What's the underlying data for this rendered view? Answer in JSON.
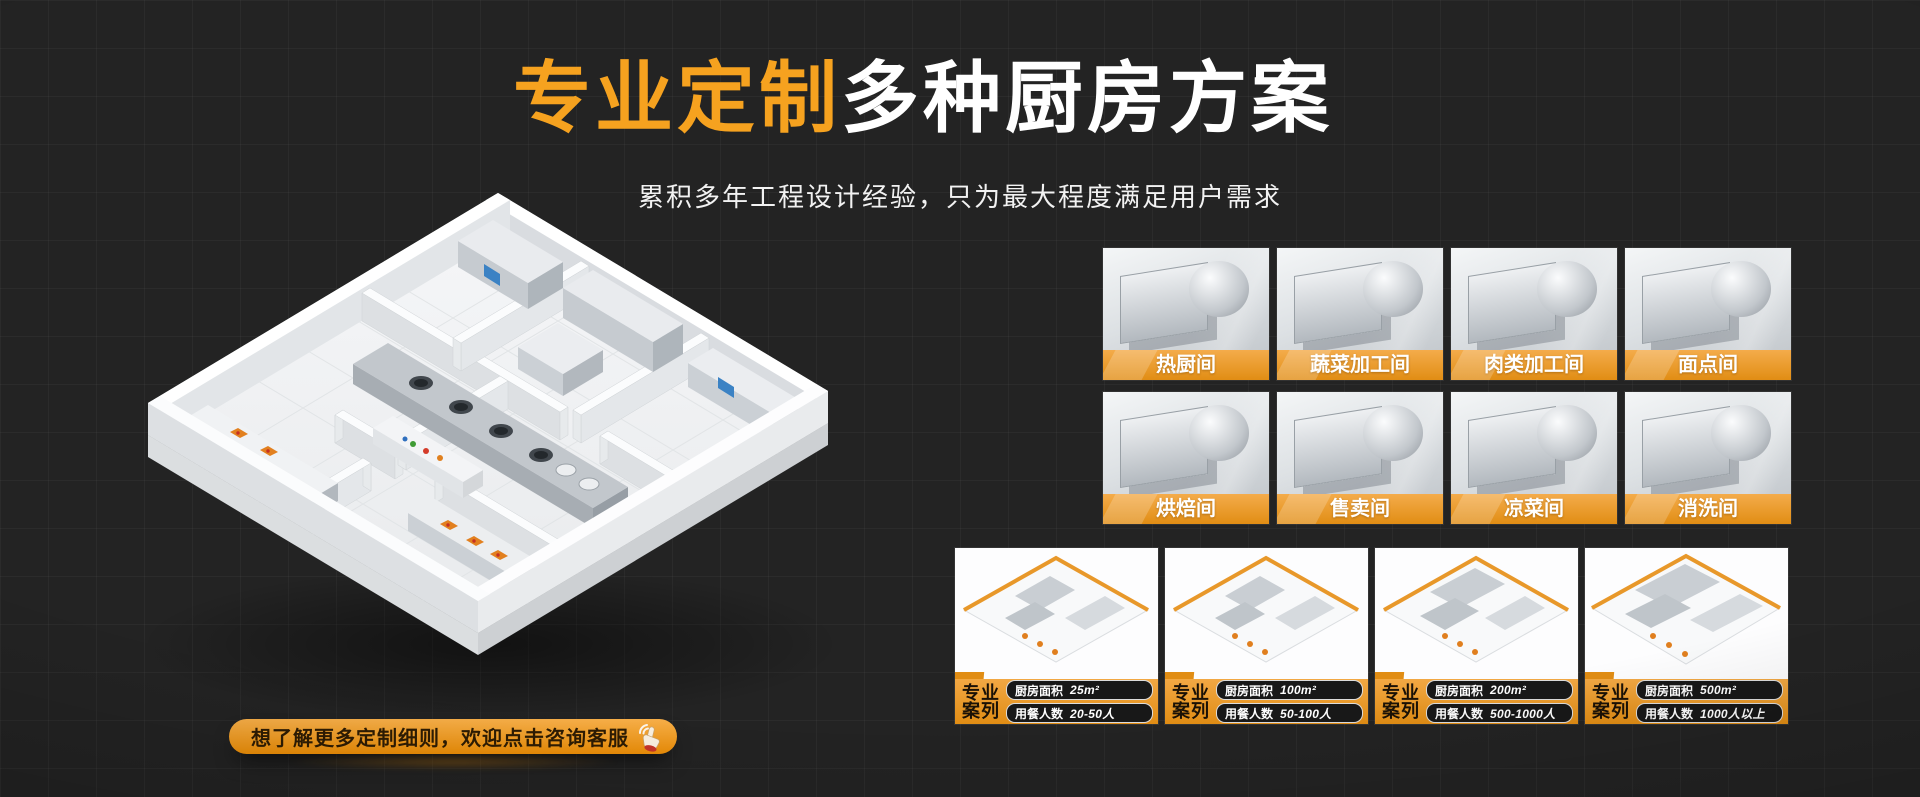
{
  "hero": {
    "title_highlight": "专业定制",
    "title_rest": "多种厨房方案",
    "subtitle": "累积多年工程设计经验，只为最大程度满足用户需求"
  },
  "cta": {
    "label": "想了解更多定制细则，欢迎点击咨询客服"
  },
  "rooms": {
    "items": [
      {
        "label": "热厨间"
      },
      {
        "label": "蔬菜加工间"
      },
      {
        "label": "肉类加工间"
      },
      {
        "label": "面点间"
      },
      {
        "label": "烘焙间"
      },
      {
        "label": "售卖间"
      },
      {
        "label": "凉菜间"
      },
      {
        "label": "消洗间"
      }
    ]
  },
  "cases": {
    "tag_line1": "专业",
    "tag_line2": "案列",
    "area_label": "厨房面积",
    "diners_label": "用餐人数",
    "items": [
      {
        "area": "25m²",
        "diners": "20-50人"
      },
      {
        "area": "100m²",
        "diners": "50-100人"
      },
      {
        "area": "200m²",
        "diners": "500-1000人"
      },
      {
        "area": "500m²",
        "diners": "1000人以上"
      }
    ]
  },
  "colors": {
    "accent_orange": "#F6A21F",
    "band_top": "#F2A844",
    "band_bottom": "#E18D14",
    "background": "#232323"
  }
}
